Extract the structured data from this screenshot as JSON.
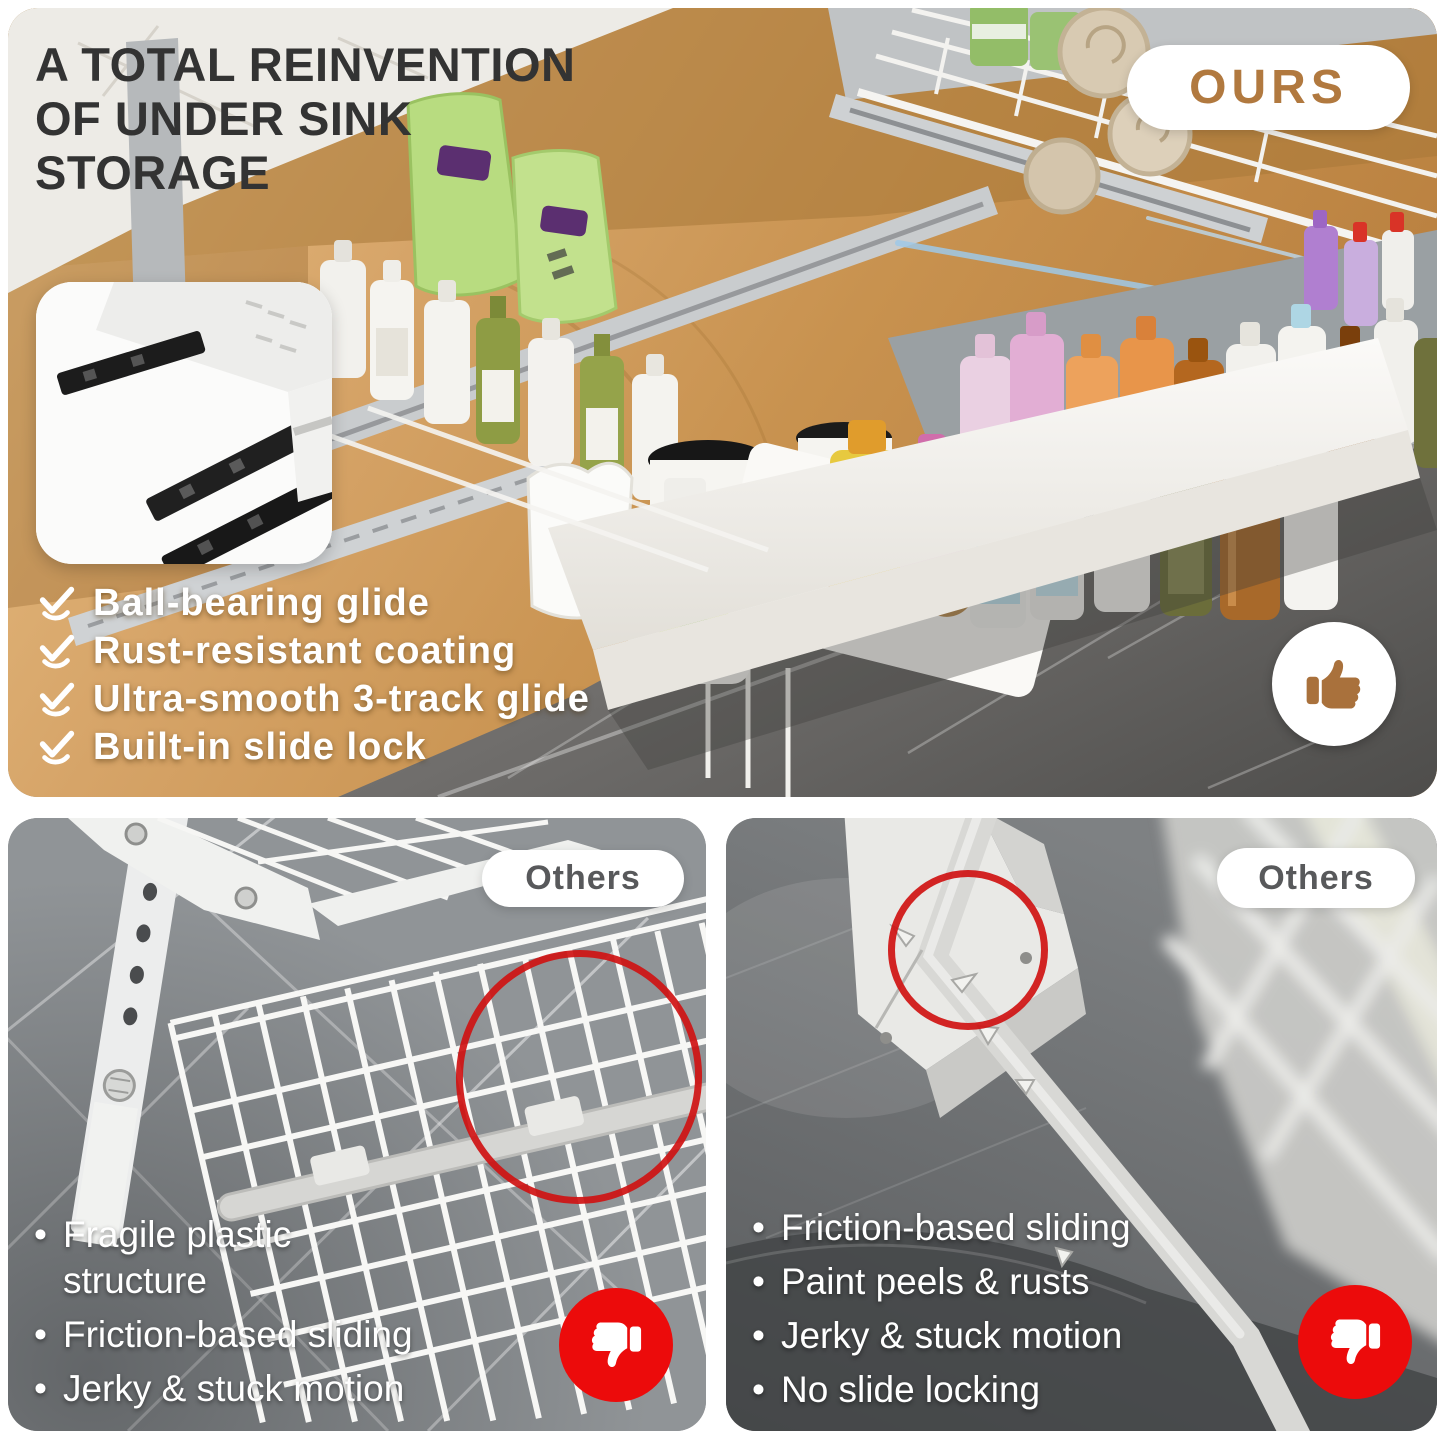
{
  "header": {
    "title_lines": [
      "A TOTAL REINVENTION",
      "OF UNDER SINK",
      "STORAGE"
    ],
    "ours_badge": "OURS"
  },
  "features": {
    "items": [
      "Ball-bearing glide",
      "Rust-resistant coating",
      "Ultra-smooth 3-track glide",
      "Built-in slide lock"
    ]
  },
  "competitor_left": {
    "badge": "Others",
    "bullets": [
      "Fragile plastic structure",
      "Friction-based sliding",
      "Jerky & stuck motion"
    ]
  },
  "competitor_right": {
    "badge": "Others",
    "bullets": [
      "Friction-based sliding",
      "Paint peels & rusts",
      "Jerky & stuck motion",
      "No slide locking"
    ]
  },
  "colors": {
    "accent_brown": "#b1793f",
    "thumb_up_brown": "#a9713c",
    "thumb_down_red": "#ec0b0b",
    "annotation_red": "#cf1212",
    "title_dark": "#333333",
    "badge_gray": "#58595b",
    "wood": "#d2a263",
    "marble_floor_gray": "#6e6d6b",
    "tile_gray": "#909497"
  }
}
